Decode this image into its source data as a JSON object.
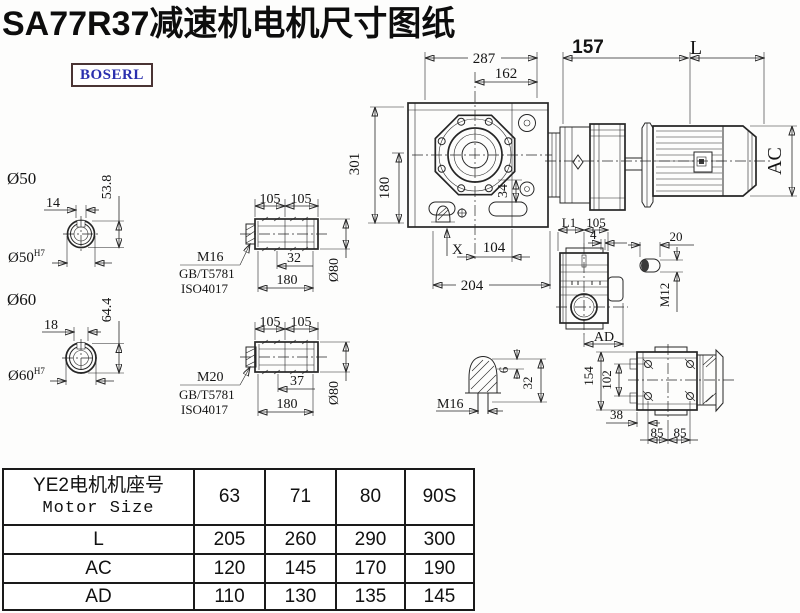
{
  "title": "SA77R37减速机电机尺寸图纸",
  "logo": {
    "text": "BOSERL"
  },
  "colors": {
    "line": "#262626",
    "logo_text": "#2a2fae",
    "logo_border": "#4a3434",
    "title_text": "#0d0d0d"
  },
  "dims": {
    "main": {
      "w287": "287",
      "w162": "162",
      "w157": "157",
      "len": "L",
      "ac": "AC",
      "h301": "301",
      "h180": "180",
      "d34": "34",
      "x": "X",
      "w104": "104",
      "w204": "204"
    },
    "bore50": {
      "dia": "Ø50",
      "fit": "Ø50",
      "fit_sup": "H7",
      "key_w": "14",
      "key_h": "53.8"
    },
    "bore60": {
      "dia": "Ø60",
      "fit": "Ø60",
      "fit_sup": "H7",
      "key_w": "18",
      "key_h": "64.4"
    },
    "sleeve_a": {
      "l1": "105",
      "l2": "105",
      "bolt": "M16",
      "std1": "GB/T5781",
      "std2": "ISO4017",
      "depth": "32",
      "len": "180",
      "dia": "Ø80"
    },
    "sleeve_b": {
      "l1": "105",
      "l2": "105",
      "bolt": "M20",
      "std1": "GB/T5781",
      "std2": "ISO4017",
      "depth": "37",
      "len": "180",
      "dia": "Ø80"
    },
    "side": {
      "l1": "L1",
      "w105": "105",
      "w4": "4",
      "ad": "AD"
    },
    "key": {
      "w20": "20",
      "thread": "M12"
    },
    "plug": {
      "thread": "M16",
      "h6": "6",
      "h32": "32"
    },
    "top": {
      "h154": "154",
      "h102": "102",
      "w38": "38",
      "w85a": "85",
      "w85b": "85"
    }
  },
  "table": {
    "header_cn": "YE2电机机座号",
    "header_en": "Motor Size",
    "sizes": [
      "63",
      "71",
      "80",
      "90S"
    ],
    "rows": [
      {
        "label": "L",
        "values": [
          "205",
          "260",
          "290",
          "300"
        ]
      },
      {
        "label": "AC",
        "values": [
          "120",
          "145",
          "170",
          "190"
        ]
      },
      {
        "label": "AD",
        "values": [
          "110",
          "130",
          "135",
          "145"
        ]
      }
    ]
  }
}
